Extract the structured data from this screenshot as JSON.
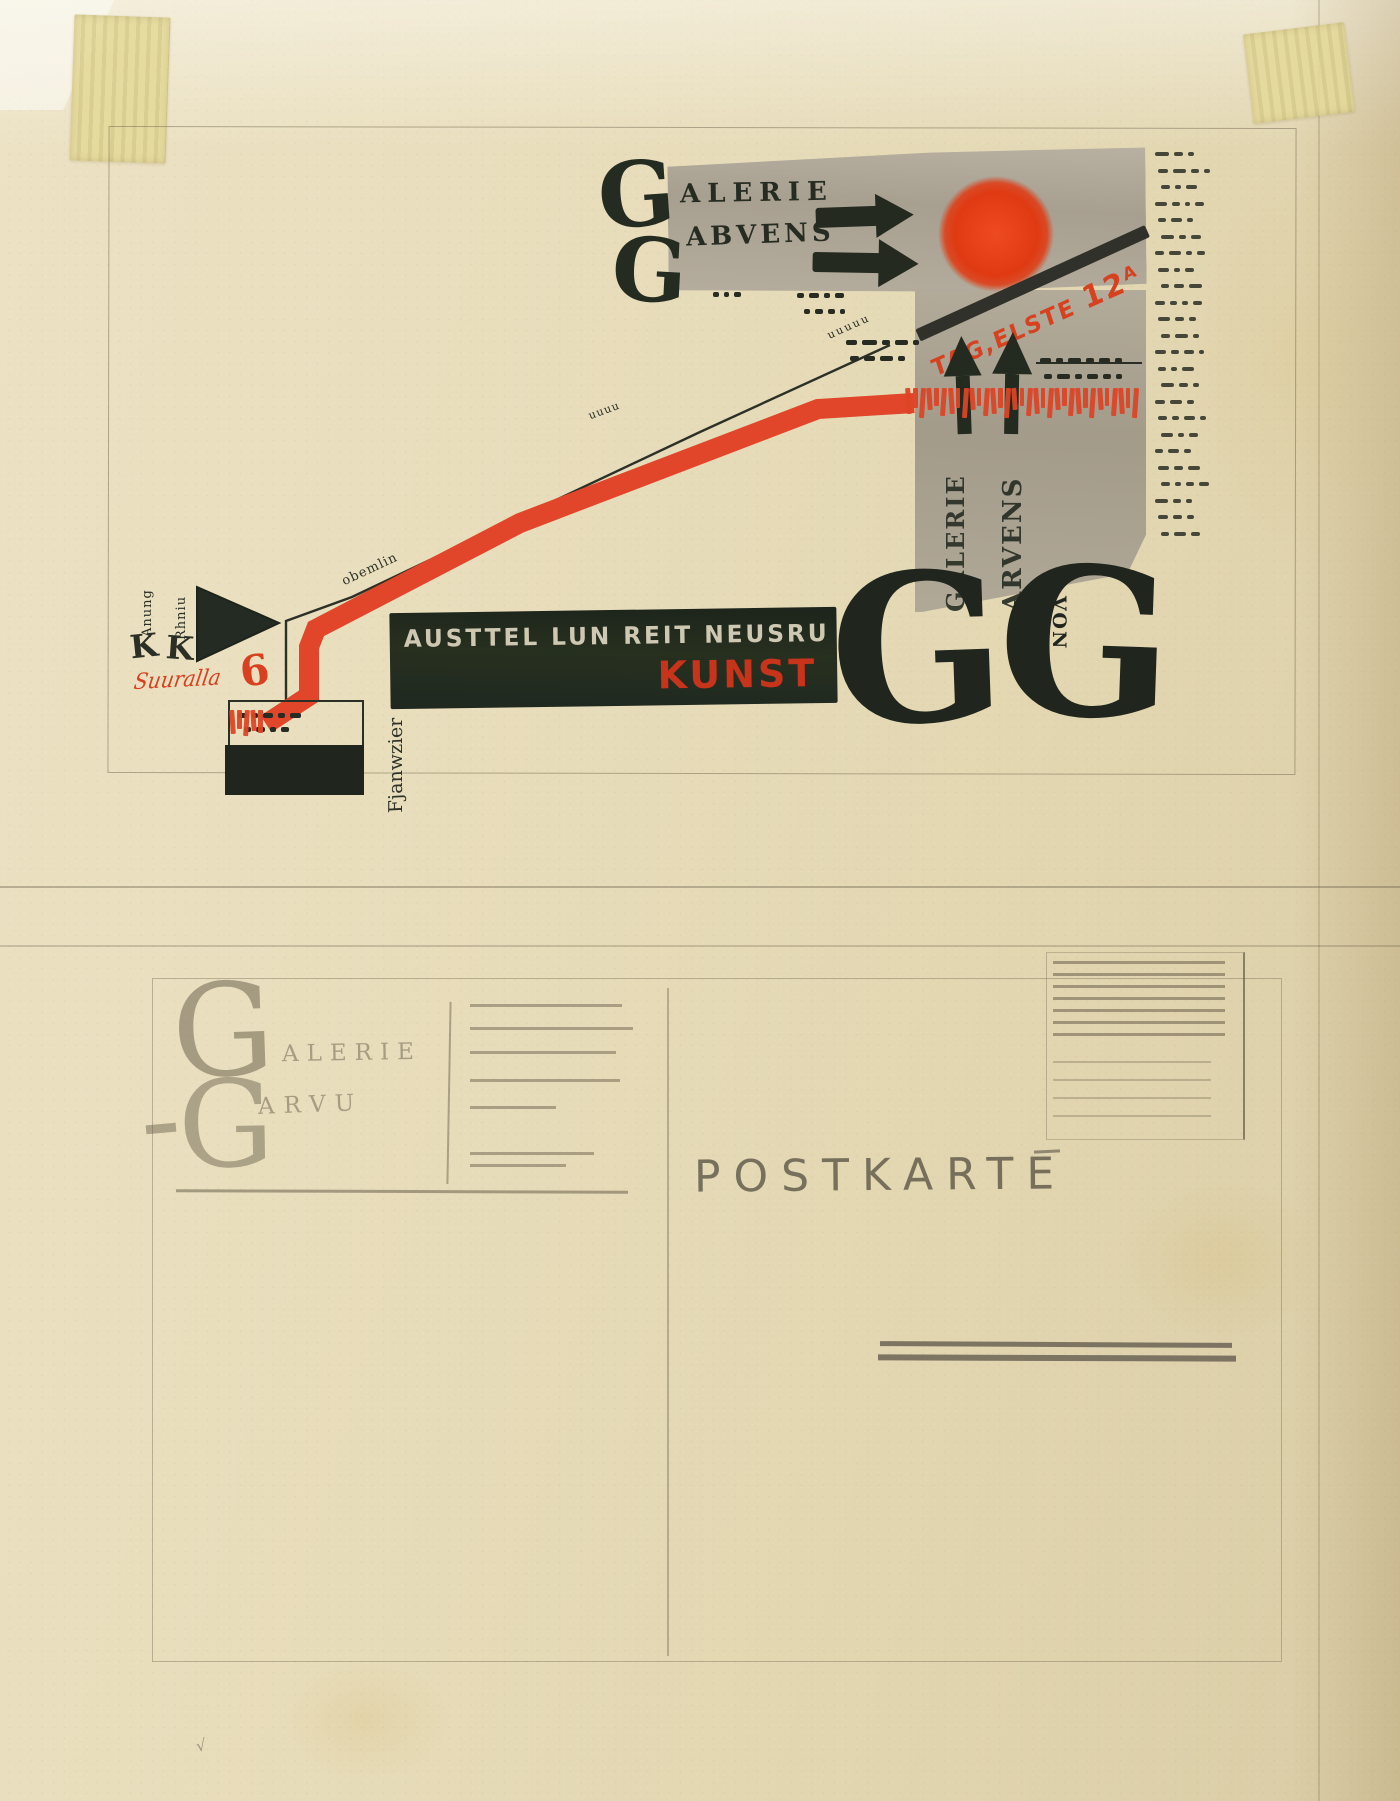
{
  "palette": {
    "paper": "#e6dbb8",
    "ink_black": "#232a20",
    "red": "#df4325",
    "red_dark": "#c53018",
    "gray_wash": "#aba293",
    "pencil": "#6c6350"
  },
  "map_side": {
    "logo": {
      "g1": "G",
      "g2": "G",
      "line1": "ALERIE",
      "line2": "ABVENS"
    },
    "street_sign": {
      "text": "TAG,ELSTE",
      "number": "12",
      "sup": "A"
    },
    "vertical_words": {
      "col1": "GALERIE",
      "col2": "ARVENS"
    },
    "banner": {
      "white_text": "AUSTTEL LUN REIT NEUSRU",
      "red_text": "KUNST"
    },
    "big_letters": {
      "left": "G",
      "right": "G"
    },
    "von_label": "VON",
    "route_small_label": "obemlin",
    "hill_small_label": "uuuu",
    "scallop_label": "uuuuu",
    "station": {
      "col1_small": "Anung",
      "col1_big": "K",
      "col2_small": "Rhniu",
      "col2_big": "K",
      "red_script": "Suuralla",
      "red_number": "6"
    },
    "box_vertical_label": "Fjanwzier"
  },
  "postcard_side": {
    "logo_g1": "G",
    "logo_line1": "ALERIE",
    "logo_g2": "G",
    "logo_line2": "ARVU",
    "title": "POSTKARTE"
  },
  "scribbles": {
    "dash_rows": [
      {
        "x": 846,
        "y": 340,
        "d": [
          11,
          15,
          8,
          13,
          6
        ]
      },
      {
        "x": 850,
        "y": 356,
        "d": [
          9,
          11,
          13,
          7
        ]
      },
      {
        "x": 1040,
        "y": 358,
        "d": [
          11,
          7,
          13,
          8,
          11,
          7
        ]
      },
      {
        "x": 1044,
        "y": 374,
        "d": [
          8,
          13,
          7,
          11,
          8,
          6
        ]
      },
      {
        "x": 797,
        "y": 293,
        "d": [
          7,
          10,
          6,
          9
        ]
      },
      {
        "x": 804,
        "y": 309,
        "d": [
          6,
          8,
          7,
          5
        ]
      },
      {
        "x": 713,
        "y": 292,
        "d": [
          6,
          5,
          7
        ]
      },
      {
        "x": 238,
        "y": 713,
        "d": [
          9,
          6,
          10,
          7,
          11
        ]
      },
      {
        "x": 244,
        "y": 727,
        "d": [
          7,
          9,
          6,
          8
        ]
      }
    ],
    "margin_column": {
      "x": 1155,
      "y": 152,
      "step": 16.5,
      "rows": [
        [
          14,
          9,
          6
        ],
        [
          10,
          13,
          8,
          6
        ],
        [
          9,
          6,
          11
        ],
        [
          12,
          8,
          5,
          9
        ],
        [
          8,
          11,
          6
        ],
        [
          13,
          7,
          10
        ],
        [
          9,
          12,
          6,
          8
        ],
        [
          11,
          6,
          9
        ],
        [
          8,
          10,
          13
        ],
        [
          10,
          7,
          6,
          9
        ],
        [
          12,
          9,
          7
        ],
        [
          9,
          13,
          6
        ],
        [
          11,
          8,
          10,
          5
        ],
        [
          8,
          6,
          12
        ],
        [
          13,
          9,
          6
        ],
        [
          10,
          12,
          7
        ],
        [
          9,
          7,
          11,
          6
        ],
        [
          12,
          6,
          9
        ],
        [
          8,
          11,
          7
        ],
        [
          11,
          9,
          12
        ],
        [
          9,
          6,
          8,
          10
        ],
        [
          13,
          8,
          6
        ],
        [
          10,
          9,
          7
        ],
        [
          8,
          12,
          9
        ]
      ]
    },
    "red_tick_bands": [
      {
        "x": 906,
        "y": 388,
        "count": 33,
        "w": 4.5,
        "gap": 2.6,
        "heights": [
          26,
          20,
          30,
          22,
          18,
          28
        ]
      },
      {
        "x": 230,
        "y": 710,
        "count": 5,
        "w": 4.5,
        "gap": 2.6,
        "heights": [
          24,
          19,
          26,
          21,
          23
        ]
      }
    ]
  },
  "postcard_layout": {
    "address_lines": {
      "x": 470,
      "rows": [
        {
          "y": 1004,
          "w": 152
        },
        {
          "y": 1027,
          "w": 163
        },
        {
          "y": 1051,
          "w": 146
        },
        {
          "y": 1079,
          "w": 150
        },
        {
          "y": 1106,
          "w": 86
        },
        {
          "y": 1152,
          "w": 124
        },
        {
          "y": 1164,
          "w": 96
        }
      ]
    },
    "stamp": {
      "x": 1046,
      "y": 952,
      "w": 196,
      "h": 186,
      "dense_ys": [
        8,
        20,
        32,
        44,
        56,
        68,
        80
      ],
      "sparse_ys": [
        108,
        126,
        144,
        162
      ],
      "line_x": 6,
      "line_w": 172
    }
  }
}
